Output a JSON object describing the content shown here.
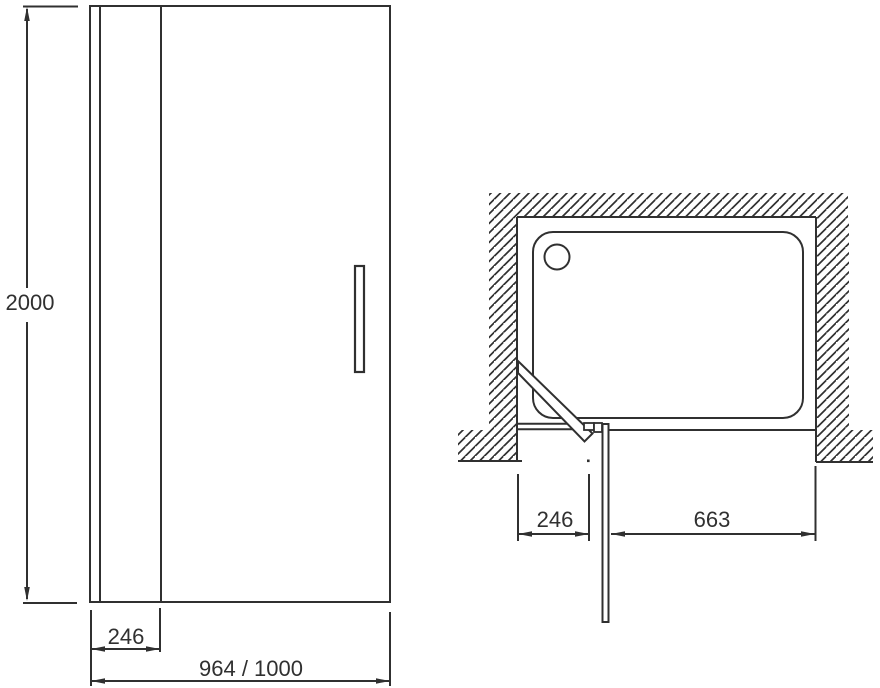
{
  "colors": {
    "line": "#303030",
    "background": "#ffffff"
  },
  "front_view": {
    "height": "2000",
    "fixed_panel_width": "246",
    "overall_width": "964 / 1000"
  },
  "plan_view": {
    "fixed_panel_width": "246",
    "opening_width": "663"
  }
}
